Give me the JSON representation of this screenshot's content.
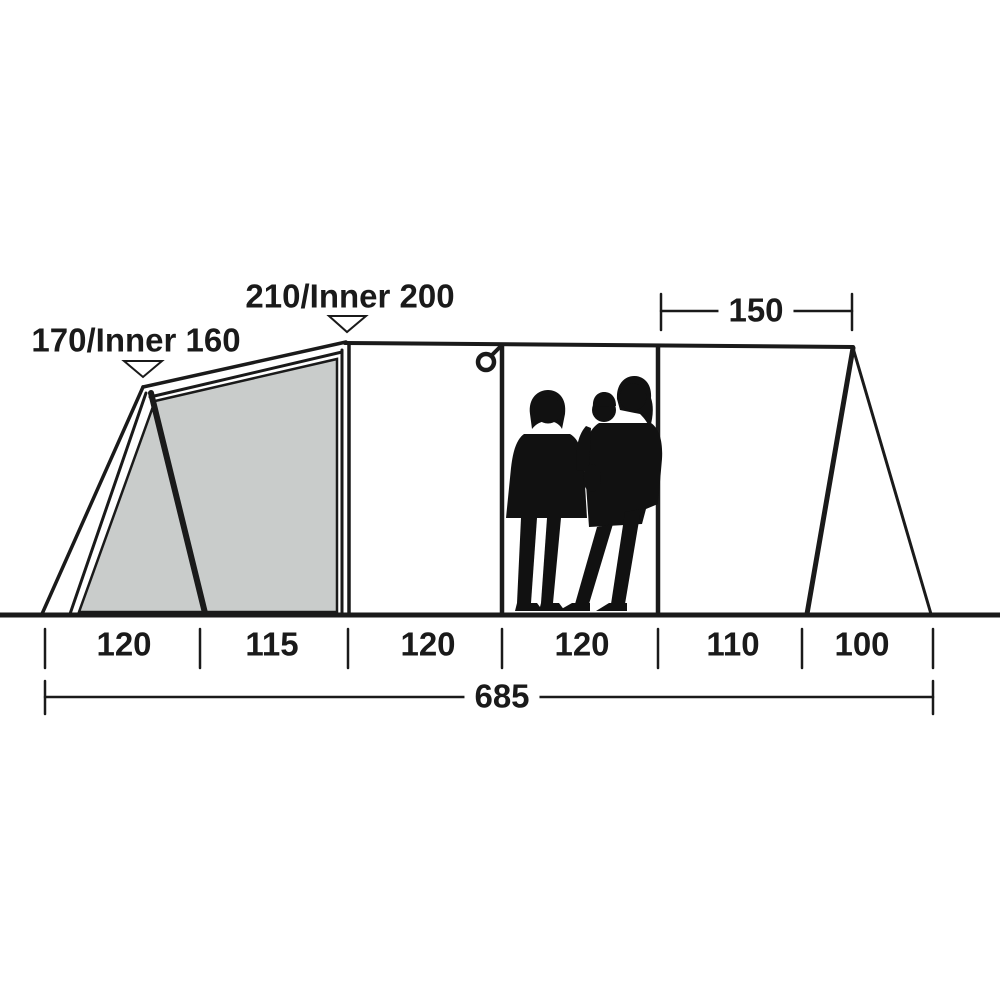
{
  "diagram": {
    "title": "tent-side-profile-dimension-diagram",
    "labels": {
      "front_height": "170/Inner 160",
      "main_height": "210/Inner 200",
      "top_width": "150",
      "total_width": "685",
      "sections": [
        "120",
        "115",
        "120",
        "120",
        "110",
        "100"
      ]
    },
    "values": {
      "front_height_cm": 170,
      "front_inner_height_cm": 160,
      "main_height_cm": 210,
      "main_inner_height_cm": 200,
      "top_width_cm": 150,
      "section_widths_cm": [
        120,
        115,
        120,
        120,
        110,
        100
      ],
      "total_width_cm": 685
    },
    "colors": {
      "line": "#1a1a1a",
      "inner_tent_fill": "#c9cccb",
      "background": "#ffffff"
    }
  }
}
